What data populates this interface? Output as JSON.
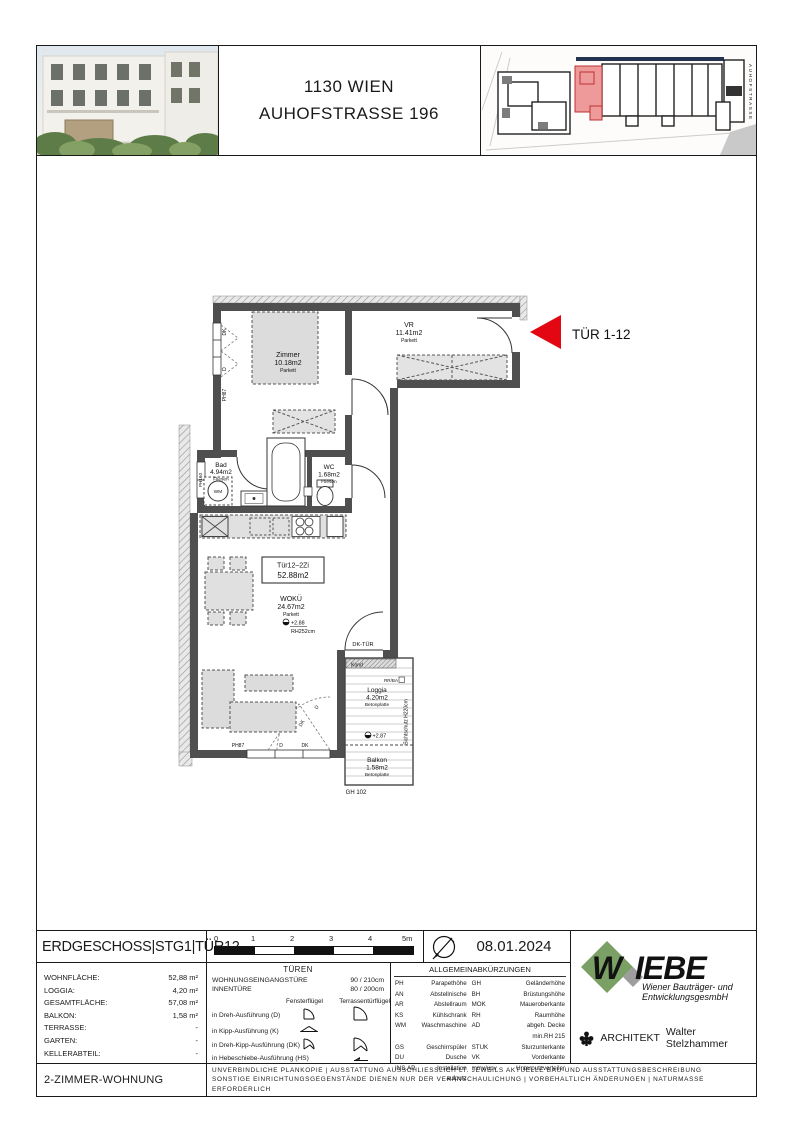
{
  "header": {
    "title_line1": "1130 WIEN",
    "title_line2": "AUHOFSTRASSE 196",
    "siteplan_street_label": "AUHOFSTRASSE"
  },
  "plan": {
    "entrance": "TÜR 1-12",
    "unit_box_line1": "Tür12–2Zi",
    "unit_box_line2": "52.88m2",
    "rooms": {
      "zimmer_name": "Zimmer",
      "zimmer_area": "10.18m2",
      "zimmer_floor": "Parkett",
      "vr_name": "VR",
      "vr_area": "11.41m2",
      "vr_floor": "Parkett",
      "bad_name": "Bad",
      "bad_area": "4.94m2",
      "bad_floor": "Fliesen",
      "wc_name": "WC",
      "wc_area": "1.68m2",
      "wc_floor": "Fliesen",
      "woku_name": "WOKÜ",
      "woku_area": "24.67m2",
      "woku_floor": "Parkett",
      "loggia_name": "Loggia",
      "loggia_area": "4.20m2",
      "loggia_floor": "Betonplatte",
      "balkon_name": "Balkon",
      "balkon_area": "1.58m2",
      "balkon_floor": "Betonplatte"
    },
    "ann": {
      "level_woku": "+2.88",
      "rh_woku": "RH252cm",
      "level_loggia": "+2.87",
      "dk_tuer": "DK-TÜR",
      "kond": "Kond",
      "rr_ba": "RR/BA",
      "sichtschutz": "Sichtschutz H220cm",
      "gh": "GH 102",
      "wm": "WM",
      "w_dk": "DK",
      "w_d": "D",
      "w_ph87": "PH87",
      "w_ph160": "PH160",
      "wb_ph87": "PH87",
      "wb_d": "D",
      "wb_dk": "DK",
      "t_d": "D",
      "t_dk": "DK"
    }
  },
  "footer": {
    "plan_title": "ERDGESCHOSS|STG1|TÜR12",
    "scale_ticks": [
      "0",
      "1",
      "2",
      "3",
      "4",
      "5m"
    ],
    "date": "08.01.2024",
    "areas": [
      {
        "label": "WOHNFLÄCHE:",
        "value": "52,88 m²"
      },
      {
        "label": "LOGGIA:",
        "value": "4,20 m²"
      },
      {
        "label": "GESAMTFLÄCHE:",
        "value": "57,08 m²"
      },
      {
        "label": "BALKON:",
        "value": "1,58 m²"
      },
      {
        "label": "TERRASSE:",
        "value": "-"
      },
      {
        "label": "GARTEN:",
        "value": "-"
      },
      {
        "label": "KELLERABTEIL:",
        "value": "-"
      }
    ],
    "unit_type": "2-ZIMMER-WOHNUNG",
    "tueren": {
      "header": "TÜREN",
      "door_rows": [
        {
          "label": "WOHNUNGSEINGANGSTÜRE",
          "value": "90 / 210cm"
        },
        {
          "label": "INNENTÜRE",
          "value": "80 / 200cm"
        }
      ],
      "col_fenster": "Fensterflügel",
      "col_terrasse": "Terrassentürflügel",
      "variants": [
        "in Dreh-Ausführung (D)",
        "in Kipp-Ausführung (K)",
        "in Dreh-Kipp-Ausführung (DK)",
        "in Hebeschiebe-Ausführung (HS)"
      ]
    },
    "abbr": {
      "header": "ALLGEMEINABKÜRZUNGEN",
      "rows": [
        [
          "PH",
          "Parapethöhe",
          "GH",
          "Geländerhöhe"
        ],
        [
          "AN",
          "Abstellnische",
          "BH",
          "Brüstungshöhe"
        ],
        [
          "AR",
          "Abstellraum",
          "MOK",
          "Maueroberkante"
        ],
        [
          "KS",
          "Kühlschrank",
          "RH",
          "Raumhöhe"
        ],
        [
          "WM",
          "Waschmaschine",
          "AD",
          "abgeh. Decke min.RH 215"
        ],
        [
          "GS",
          "Geschirrspüler",
          "STUK",
          "Sturzunterkante"
        ],
        [
          "DU",
          "Dusche",
          "VK",
          "Vorderkante"
        ],
        [
          "INS.AP",
          "Installation aufputz",
          "mmv/upv",
          "Unterputzverteiler"
        ]
      ]
    },
    "brand": {
      "name_w": "W",
      "name_rest": "IEBE",
      "sub1": "Wiener Bauträger- und",
      "sub2": "EntwicklungsgesmbH",
      "architect_label": "ARCHITEKT",
      "architect_name": "Walter Stelzhammer"
    },
    "disclaimer1": "UNVERBINDLICHE PLANKOPIE | AUSSTATTUNG AUSSCHLIESSLICH LT. JEWEILS AKTUELLE BAU-UND AUSSTATTUNGSBESCHREIBUNG",
    "disclaimer2": "SONSTIGE EINRICHTUNGSGEGENSTÄNDE DIENEN NUR DER VERANSCHAULICHUNG | VORBEHALTLICH ÄNDERUNGEN | NATURMASSE ERFORDERLICH"
  },
  "colors": {
    "accent_red": "#e30613",
    "logo_green": "#7ba065",
    "wall_gray": "#4f4f4f",
    "unit_red": "#ef9a9a"
  }
}
